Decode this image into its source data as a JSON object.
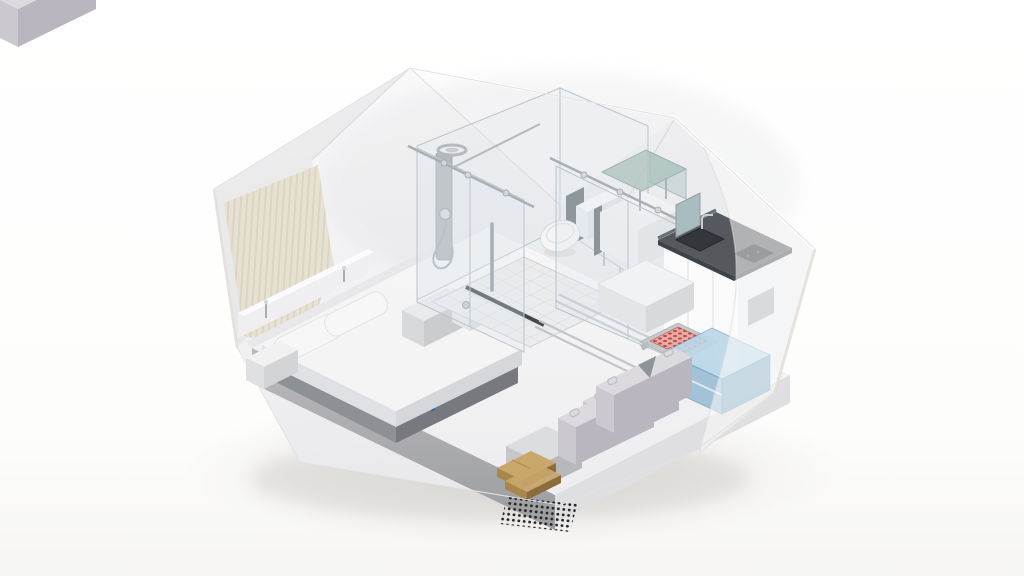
{
  "scene": {
    "description": "Isometric 3D cutaway rendering of a compact micro-home interior under a white faceted tent-like shell, on a white studio background",
    "rooms": [
      "bedroom",
      "bathroom",
      "kitchenette",
      "utility-zone",
      "entry"
    ],
    "objects": {
      "shell": [
        "faceted translucent tent canopy",
        "wood-grain side facet",
        "translucent front-right fabric panel"
      ],
      "bedroom": [
        "low platform bed with white mattress",
        "two white pillows",
        "small blue mattress tag",
        "headboard half-wall with chrome hooks",
        "white nightstand block",
        "gray foot bench"
      ],
      "bathroom": [
        "tall glass shower enclosure with sliding-door rails and rollers",
        "gray shower column with round rain head and handheld sprayer on hose",
        "tiled shower tray with dark linear drain and round drain cap",
        "wall-hung white toilet with concealed carrier",
        "white vanity cabinet with dark end panel",
        "tinted glass shelf and mirror panel"
      ],
      "kitchenette": [
        "white counter unit with dark gray worktop",
        "inset sink with chrome faucet",
        "black cooktop",
        "dark backsplash mirror panel",
        "open niche in side panel"
      ],
      "utility": [
        "twin pipe runs across the floor",
        "white water-heater box",
        "red dotted heat-exchanger grid on gray tray",
        "translucent blue water tank",
        "three gray utility modules with clear handles",
        "gray airflow arrow decal"
      ],
      "entry": [
        "two-board wooden step",
        "black dotted doormat grid"
      ]
    }
  },
  "colors": {
    "bg": "#ffffff",
    "ground-shade": "#dcdad6",
    "shell-light": "#f7f7f8",
    "shell-mid": "#efeff1",
    "shell-dark": "#e6e6e8",
    "shell-edge-warm": "#dcd5c8",
    "wood-panel": "#e7e0d1",
    "wood-stripe": "#d3c9b3",
    "floor": "#f2f2f4",
    "plinth-left": "#b0b1b4",
    "plinth-right": "#dfdfe1",
    "floor-rim": "#e8e8ea",
    "mattress-top": "#f4f4f5",
    "mattress-side": "#e0e1e4",
    "bed-base": "#8d9095",
    "tag-blue": "#2f6bb0",
    "pillow": "#f7f7f8",
    "glass-fill": "rgba(226,233,237,0.30)",
    "glass-edge": "#bcc4ca",
    "chrome": "#a9afb5",
    "chrome-light": "#d3d7da",
    "tray": "#eaecee",
    "tray-grid": "#d2d5d8",
    "drain-dark": "#46494d",
    "porcelain": "#f3f5f6",
    "carrier-dark": "#6e7578",
    "counter-top": "#55595e",
    "counter-face": "#fafafb",
    "counter-side": "#eceeef",
    "sink-dark": "#33373b",
    "mirror-glass": "#a9bcc0",
    "shelf-glass": "rgba(171,193,189,0.75)",
    "pipe": "#c3c5c8",
    "heater-box": "#f1f2f3",
    "exchanger-red": "#c8453d",
    "exchanger-tray": "#c6c9cb",
    "tank-top": "rgba(187,215,231,0.92)",
    "tank-left": "rgba(150,187,211,0.88)",
    "tank-right": "rgba(128,168,196,0.88)",
    "module-top": "#dcdade",
    "module-front": "#cbc8cf",
    "module-side": "#bab6c0",
    "arrow-gray": "#8f9499",
    "step-top": "#c9a76b",
    "step-front": "#a9864c",
    "step-side": "#8d6c3b",
    "mat-dot": "#232323"
  }
}
